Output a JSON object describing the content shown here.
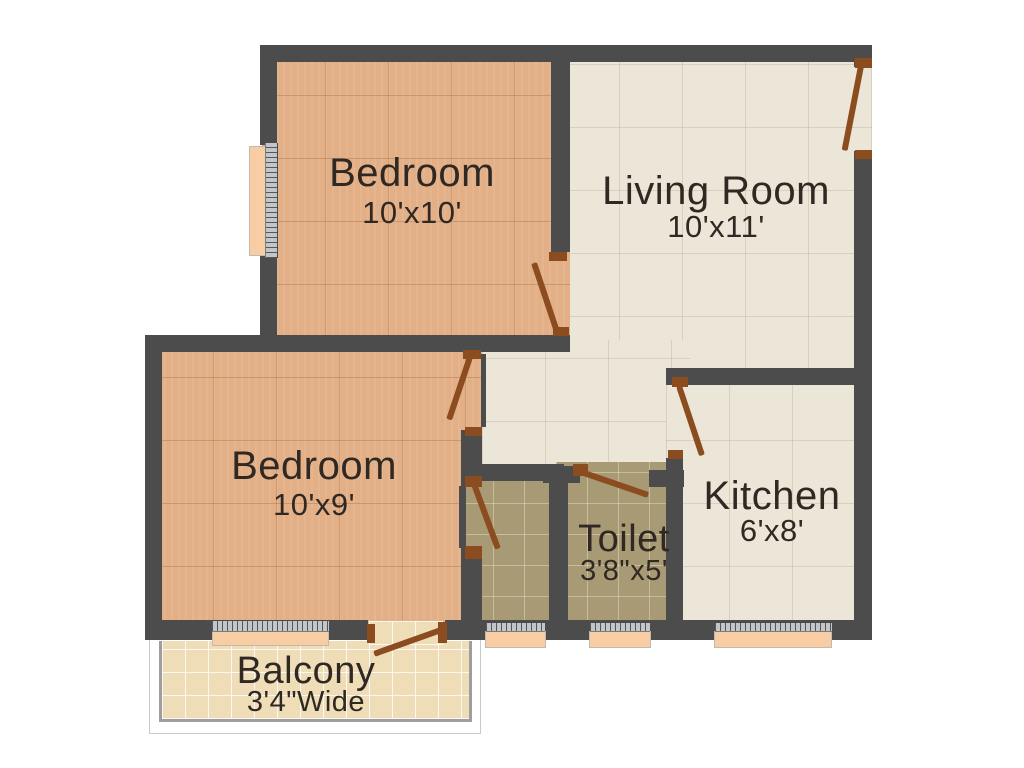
{
  "plan": {
    "canvas": {
      "width": 1024,
      "height": 768,
      "background": "#ffffff"
    },
    "palette": {
      "wall": "#4c4c4c",
      "wood_floor": "#e2af86",
      "cream_floor": "#ece6d8",
      "khaki_floor": "#a79a74",
      "balcony_floor": "#efddb8",
      "door": "#8b4d1f",
      "window_sill": "#f8cda3",
      "window_frame": "#c3c6c8",
      "railing": "#9e9e9e",
      "text": "#2f2823"
    },
    "rooms": [
      {
        "name": "Bedroom",
        "dims": "10'x10'",
        "cx": 412,
        "name_y": 153,
        "name_size": 40,
        "dims_y": 197,
        "dims_size": 31
      },
      {
        "name": "Living Room",
        "dims": "10'x11'",
        "cx": 716,
        "name_y": 171,
        "name_size": 40,
        "dims_y": 211,
        "dims_size": 31
      },
      {
        "name": "Bedroom",
        "dims": "10'x9'",
        "cx": 314,
        "name_y": 446,
        "name_size": 40,
        "dims_y": 489,
        "dims_size": 31
      },
      {
        "name": "Kitchen",
        "dims": "6'x8'",
        "cx": 772,
        "name_y": 476,
        "name_size": 40,
        "dims_y": 515,
        "dims_size": 31
      },
      {
        "name": "Toilet",
        "dims": "3'8\"x5'",
        "cx": 624,
        "name_y": 520,
        "name_size": 38,
        "dims_y": 557,
        "dims_size": 29
      },
      {
        "name": "Balcony",
        "dims": "3'4\"Wide",
        "cx": 306,
        "name_y": 652,
        "name_size": 38,
        "dims_y": 688,
        "dims_size": 29
      }
    ],
    "floors": [
      {
        "name": "living-room-floor",
        "kind": "cream",
        "rect": [
          556,
          50,
          316,
          330
        ]
      },
      {
        "name": "hallway-floor",
        "kind": "cream",
        "rect": [
          482,
          340,
          208,
          145
        ]
      },
      {
        "name": "bedroom-1-floor",
        "kind": "wood",
        "rect": [
          262,
          50,
          308,
          298
        ]
      },
      {
        "name": "bedroom-2-floor",
        "kind": "wood",
        "rect": [
          150,
          340,
          332,
          290
        ]
      },
      {
        "name": "bathroom-floor",
        "kind": "khaki",
        "rect": [
          462,
          475,
          98,
          153
        ]
      },
      {
        "name": "toilet-floor",
        "kind": "khaki",
        "rect": [
          556,
          462,
          116,
          166
        ]
      },
      {
        "name": "kitchen-floor",
        "kind": "cream",
        "rect": [
          666,
          372,
          194,
          258
        ]
      },
      {
        "name": "balcony-outer-frame",
        "kind": "white",
        "rect": [
          149,
          638,
          332,
          96
        ]
      },
      {
        "name": "balcony-floor",
        "kind": "balcony",
        "rect": [
          162,
          641,
          307,
          78
        ]
      },
      {
        "name": "balcony-railing",
        "kind": "railing",
        "rect": [
          159,
          641,
          313,
          81
        ]
      },
      {
        "name": "balcony-door-floor",
        "kind": "balcony",
        "rect": [
          369,
          621,
          74,
          24
        ]
      }
    ],
    "walls": [
      {
        "name": "wall-top",
        "rect": [
          260,
          45,
          612,
          17
        ]
      },
      {
        "name": "wall-bedroom1-left-upper",
        "rect": [
          260,
          45,
          17,
          100
        ]
      },
      {
        "name": "wall-bedroom1-left-lower",
        "rect": [
          260,
          256,
          17,
          96
        ]
      },
      {
        "name": "wall-bedroom1-right",
        "rect": [
          551,
          45,
          19,
          207
        ]
      },
      {
        "name": "wall-mid-horizontal",
        "rect": [
          145,
          335,
          425,
          17
        ]
      },
      {
        "name": "wall-bedroom2-left",
        "rect": [
          145,
          335,
          17,
          302
        ]
      },
      {
        "name": "wall-bedroom2-door-edge",
        "rect": [
          481,
          354,
          5,
          73
        ]
      },
      {
        "name": "wall-bedroom2-right-stub",
        "rect": [
          461,
          430,
          21,
          56
        ]
      },
      {
        "name": "wall-bathroom-threshold",
        "rect": [
          459,
          486,
          7,
          62
        ]
      },
      {
        "name": "wall-bathroom-left-lower",
        "rect": [
          461,
          548,
          21,
          80
        ]
      },
      {
        "name": "wall-bathroom-top",
        "rect": [
          466,
          464,
          98,
          17
        ]
      },
      {
        "name": "wall-bath-toilet-divider",
        "rect": [
          549,
          478,
          19,
          150
        ]
      },
      {
        "name": "wall-toilet-top-left",
        "rect": [
          543,
          466,
          37,
          17
        ]
      },
      {
        "name": "wall-toilet-top-right",
        "rect": [
          649,
          470,
          35,
          17
        ]
      },
      {
        "name": "wall-toilet-kitchen",
        "rect": [
          666,
          458,
          17,
          170
        ]
      },
      {
        "name": "wall-kitchen-top",
        "rect": [
          666,
          368,
          206,
          17
        ]
      },
      {
        "name": "wall-right-upper",
        "rect": [
          854,
          45,
          18,
          22
        ]
      },
      {
        "name": "wall-right-lower",
        "rect": [
          854,
          151,
          18,
          489
        ]
      },
      {
        "name": "wall-bottom-left",
        "rect": [
          145,
          620,
          223,
          20
        ]
      },
      {
        "name": "wall-bottom-right",
        "rect": [
          445,
          620,
          427,
          20
        ]
      }
    ],
    "windows": [
      {
        "name": "bedroom1-window",
        "dir": "v",
        "sill": [
          249,
          146,
          18,
          110
        ],
        "frame": [
          265,
          143,
          13,
          115
        ]
      },
      {
        "name": "bedroom2-window",
        "dir": "h",
        "sill": [
          212,
          631,
          117,
          15
        ],
        "frame": [
          212,
          620,
          117,
          12
        ]
      },
      {
        "name": "bathroom-window",
        "dir": "h",
        "sill": [
          485,
          631,
          61,
          17
        ],
        "frame": [
          486,
          622,
          59,
          10
        ]
      },
      {
        "name": "toilet-window",
        "dir": "h",
        "sill": [
          589,
          631,
          62,
          17
        ],
        "frame": [
          590,
          622,
          60,
          10
        ]
      },
      {
        "name": "kitchen-window",
        "dir": "h",
        "sill": [
          714,
          631,
          118,
          17
        ],
        "frame": [
          715,
          622,
          117,
          10
        ]
      }
    ],
    "doors": [
      {
        "name": "entrance-door",
        "hinge": [
          861,
          66
        ],
        "len": 86,
        "angle": 101,
        "jambs": [
          [
            855,
            58,
            17,
            10
          ],
          [
            855,
            150,
            17,
            9
          ]
        ]
      },
      {
        "name": "bedroom1-door",
        "hinge": [
          534,
          263
        ],
        "len": 71,
        "angle": 71.5,
        "jambs": [
          [
            549,
            252,
            18,
            9
          ],
          [
            553,
            327,
            16,
            9
          ]
        ]
      },
      {
        "name": "bedroom2-door",
        "hinge": [
          470,
          357
        ],
        "len": 66,
        "angle": 108.5,
        "jambs": [
          [
            463,
            350,
            18,
            9
          ],
          [
            465,
            427,
            17,
            9
          ]
        ]
      },
      {
        "name": "bathroom-door",
        "hinge": [
          474,
          484
        ],
        "len": 69,
        "angle": 69.7,
        "jambs": [
          [
            465,
            476,
            17,
            11
          ],
          [
            465,
            546,
            17,
            13
          ]
        ]
      },
      {
        "name": "toilet-door",
        "hinge": [
          581,
          472
        ],
        "len": 71,
        "angle": 18.9,
        "jambs": [
          [
            573,
            464,
            15,
            12
          ]
        ]
      },
      {
        "name": "kitchen-door",
        "hinge": [
          679,
          386
        ],
        "len": 73,
        "angle": 71.6,
        "jambs": [
          [
            672,
            377,
            16,
            10
          ],
          [
            668,
            450,
            15,
            9
          ]
        ]
      },
      {
        "name": "balcony-door",
        "hinge": [
          441,
          630
        ],
        "len": 71,
        "angle": 160.3,
        "jambs": [
          [
            438,
            622,
            9,
            21
          ],
          [
            367,
            624,
            8,
            19
          ]
        ]
      }
    ]
  }
}
